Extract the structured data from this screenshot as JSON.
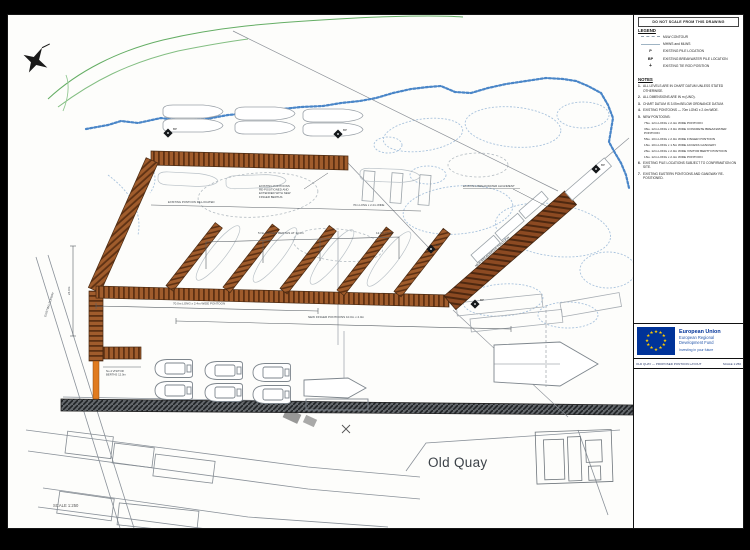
{
  "colors": {
    "pontoon_brown": "#a05c2c",
    "pontoon_stripe": "#5e3113",
    "breakwater_brown": "#8c4a22",
    "gangway_orange": "#e07b1f",
    "water_line_blue": "#4a86c8",
    "coast_green": "#4aa04a",
    "rock_outline_blue": "#a9c3dd",
    "sketch_gray": "#8a9199",
    "quay_dark": "#4a4e52",
    "eu_blue": "#003399",
    "eu_star_yellow": "#ffcc00"
  },
  "panel": {
    "warning": "DO NOT SCALE FROM THIS DRAWING",
    "legend": {
      "title": "LEGEND",
      "items": [
        {
          "symbol": "",
          "label": "MLW CONTOUR"
        },
        {
          "symbol": "",
          "label": "MHWS and MLWS"
        },
        {
          "symbol": "P",
          "label": "EXISTING PILE LOCATION"
        },
        {
          "symbol": "BP",
          "label": "EXISTING BREAKWATER PILE LOCATION"
        },
        {
          "symbol": "+",
          "label": "EXISTING TIE ROD POSITION"
        }
      ]
    },
    "notes": {
      "title": "NOTES",
      "items": [
        {
          "num": "1.",
          "text": "ALL LEVELS ARE IN CHART DATUM UNLESS STATED OTHERWISE."
        },
        {
          "num": "2.",
          "text": "ALL DIMENSIONS ARE IN m (UNO)."
        },
        {
          "num": "3.",
          "text": "CHART DATUM IS 3.05m BELOW ORDNANCE DATUM."
        },
        {
          "num": "4.",
          "text": "EXISTING PONTOONS — 70m LONG x 2.4m WIDE."
        },
        {
          "num": "5.",
          "text": "NEW PONTOONS:"
        }
      ],
      "subitems": [
        "7No. 12m LONG x 2.4m WIDE PONTOON",
        "3No. 12m LONG x 3.0m WIDE CONCRETE BREAKWATER PONTOON",
        "5No. 10m LONG x 2.0m WIDE FINGER PONTOON",
        "1No. 10m LONG x 1.5m WIDE ACCESS GANGWAY",
        "2No. 12m LONG x 2.0m WIDE VISITOR BERTH PONTOON",
        "1No. 12m LONG x 2.4m WIDE PONTOON"
      ],
      "items2": [
        {
          "num": "6.",
          "text": "EXISTING PILE LOCATIONS SUBJECT TO CONFIRMATION ON SITE."
        },
        {
          "num": "7.",
          "text": "EXISTING EASTERN PONTOONS AND GANGWAY RE-POSITIONED."
        }
      ]
    },
    "eu": {
      "line1": "European Union",
      "line2": "European Regional",
      "line3": "Development Fund",
      "line4": "Investing in your future"
    },
    "titleblock": {
      "left": "OLD QUAY — PROPOSED PONTOON LAYOUT",
      "right": "SCALE 1:250"
    }
  },
  "drawing": {
    "old_quay": "Old Quay",
    "scale_note": "SCALE 1:250",
    "bp": "BP",
    "labels": {
      "anno1": "EXISTING PONTOONS",
      "anno2": "RE-POSITIONED AND",
      "anno3": "EXTENDED WITH NEW",
      "anno4": "FINGER BERTHS",
      "breakwater_existing": "EXISTING BREAKWATER ALIGNMENT",
      "breakwater_new": "NEW BREAKWATER PONTOON",
      "top_left": "EXISTING PONTOON RE-LOCATED",
      "top_right": "70m LONG x 2.4m WIDE",
      "bracket": "5 No. FINGER BERTHS AT 12.0m",
      "bracket2": "12.0m (TYP)",
      "walkway1": "70.0m LONG x 2.4m WIDE PONTOON",
      "walkway2": "NEW FINGER PONTOONS 10.0m x 2.0m",
      "left_dim": "24.0m",
      "stub1": "No.4 VISITOR",
      "stub2": "BERTHS 12.0m",
      "slipway": "EXISTING SLIPWAY"
    }
  }
}
